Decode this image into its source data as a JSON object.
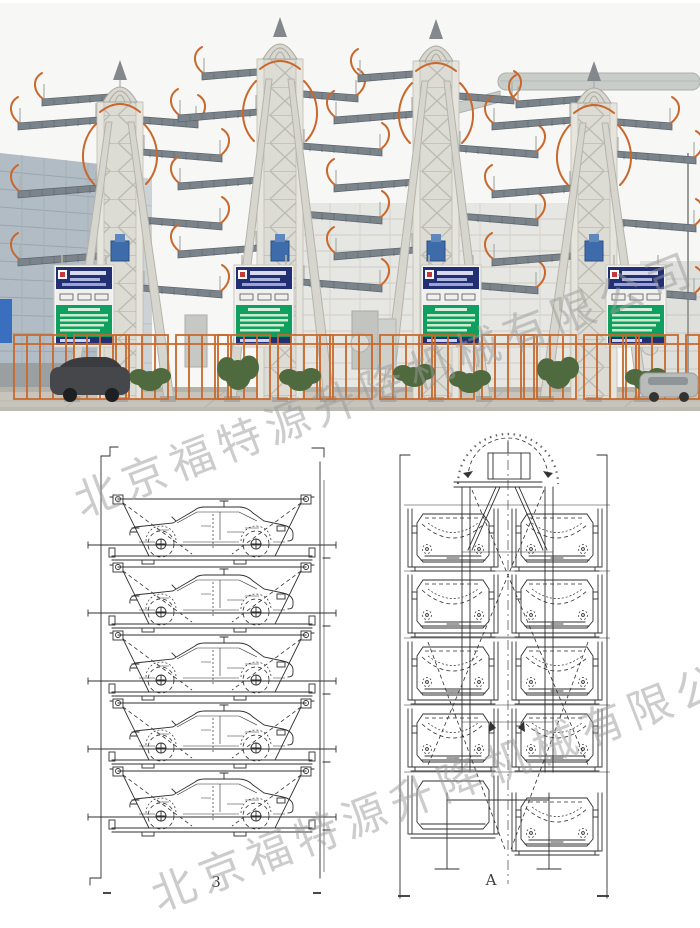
{
  "watermark": {
    "text": "北京福特源升降机械有限公司"
  },
  "figure_labels": {
    "side_view": "3",
    "front_view": "A"
  },
  "colors": {
    "accent_orange": "#c8682c",
    "sign_navy": "#232f73",
    "sign_green": "#0fa05f",
    "structure_beige": "#dcdbd3",
    "drawing_line": "#2f2f2f",
    "photo_sky": "#f7f7f5"
  }
}
